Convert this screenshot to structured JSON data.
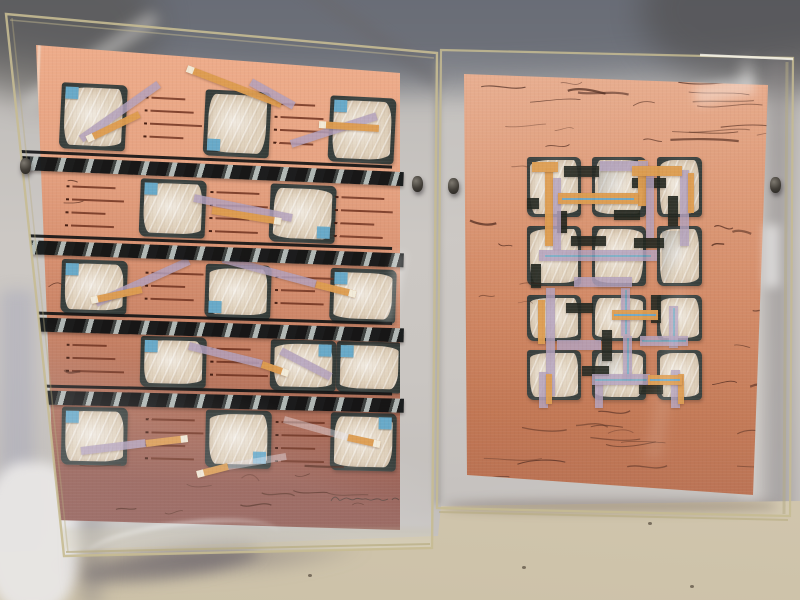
{
  "scene": {
    "type": "photograph",
    "subject": "Two abstract mixed-media collage artworks in clear acrylic box frames leaning against a gray fabric backdrop on a beige floor"
  },
  "palette": {
    "fabric": "#c6c2bf",
    "salmon_hi": "#efae8c",
    "cream": "#e0d2bd",
    "charcoal": "#3a403d",
    "blue_chip": "#68a9c8",
    "orange": "#dd9c4f",
    "lavender": "#b2a0bc",
    "pinstripe_blue": "#6fa7c4",
    "scribble": "#4a2418",
    "acrylic_edge": "#c6bb92",
    "floor": "#d5cab2"
  },
  "left_artwork": {
    "grid": {
      "cols": 5,
      "col_x": [
        26,
        105,
        170,
        235,
        295
      ],
      "cell_w": 66,
      "rows": [
        {
          "y": 37,
          "h": 66,
          "rot": 2.8,
          "cells": [
            {
              "c": 0,
              "chip": "tl"
            },
            {
              "c": 2,
              "chip": "bl"
            },
            {
              "c": 4,
              "chip": "tl"
            }
          ],
          "dash": [
            1,
            3
          ]
        },
        {
          "y": 130,
          "h": 58,
          "rot": 2.3,
          "cells": [
            {
              "c": 1,
              "chip": "tl"
            },
            {
              "c": 3,
              "chip": "br"
            }
          ],
          "dash": [
            0,
            2,
            4
          ]
        },
        {
          "y": 214,
          "h": 54,
          "rot": 1.9,
          "cells": [
            {
              "c": 0,
              "chip": "tl"
            },
            {
              "c": 2,
              "chip": "bl"
            },
            {
              "c": 4,
              "chip": "tl"
            }
          ],
          "dash": [
            1,
            3
          ]
        },
        {
          "y": 289,
          "h": 51,
          "rot": 1.5,
          "cells": [
            {
              "c": 1,
              "chip": "tl"
            },
            {
              "c": 3,
              "chip": "tr"
            },
            {
              "c": 4,
              "x": 301,
              "chip": "tl"
            }
          ],
          "dash": [
            0,
            2
          ]
        },
        {
          "y": 362,
          "h": 58,
          "rot": 1.2,
          "cells": [
            {
              "c": 0,
              "chip": "tl"
            },
            {
              "c": 2,
              "chip": "br"
            },
            {
              "c": 4,
              "chip": "tr"
            }
          ],
          "dash": [
            1,
            3
          ]
        }
      ]
    },
    "bars": {
      "x": -16,
      "w": 384,
      "items": [
        {
          "y": 106,
          "rot": 2.4
        },
        {
          "y": 190,
          "rot": 2.0
        },
        {
          "y": 267,
          "rot": 1.7
        },
        {
          "y": 340,
          "rot": 1.3
        }
      ]
    },
    "strips": [
      {
        "x1": 151,
        "y1": 24,
        "x2": 245,
        "y2": 60,
        "c": "orange",
        "tip": "start"
      },
      {
        "x1": 215,
        "y1": 38,
        "x2": 258,
        "y2": 62,
        "c": "lavender"
      },
      {
        "x1": 45,
        "y1": 95,
        "x2": 123,
        "y2": 40,
        "c": "lavender"
      },
      {
        "x1": 51,
        "y1": 95,
        "x2": 103,
        "y2": 70,
        "c": "orange",
        "tip": "start"
      },
      {
        "x1": 255,
        "y1": 100,
        "x2": 341,
        "y2": 72,
        "c": "lavender"
      },
      {
        "x1": 283,
        "y1": 80,
        "x2": 343,
        "y2": 84,
        "c": "orange",
        "tip": "start"
      },
      {
        "x1": 158,
        "y1": 154,
        "x2": 256,
        "y2": 174,
        "c": "lavender"
      },
      {
        "x1": 176,
        "y1": 166,
        "x2": 245,
        "y2": 177,
        "c": "orange",
        "tip": "end"
      },
      {
        "x1": 60,
        "y1": 259,
        "x2": 153,
        "y2": 217,
        "c": "lavender"
      },
      {
        "x1": 55,
        "y1": 256,
        "x2": 106,
        "y2": 245,
        "c": "orange",
        "tip": "start"
      },
      {
        "x1": 187,
        "y1": 215,
        "x2": 280,
        "y2": 240,
        "c": "lavender"
      },
      {
        "x1": 280,
        "y1": 240,
        "x2": 320,
        "y2": 250,
        "c": "orange",
        "tip": "end"
      },
      {
        "x1": 245,
        "y1": 307,
        "x2": 295,
        "y2": 333,
        "c": "lavender"
      },
      {
        "x1": 153,
        "y1": 302,
        "x2": 226,
        "y2": 320,
        "c": "lavender"
      },
      {
        "x1": 226,
        "y1": 320,
        "x2": 252,
        "y2": 329,
        "c": "orange",
        "tip": "end"
      },
      {
        "x1": 45,
        "y1": 407,
        "x2": 110,
        "y2": 399,
        "c": "lavender"
      },
      {
        "x1": 110,
        "y1": 399,
        "x2": 152,
        "y2": 394,
        "c": "orange",
        "tip": "end"
      },
      {
        "x1": 161,
        "y1": 430,
        "x2": 192,
        "y2": 422,
        "c": "orange",
        "tip": "start"
      },
      {
        "x1": 192,
        "y1": 422,
        "x2": 250,
        "y2": 412,
        "c": "sheer"
      },
      {
        "x1": 248,
        "y1": 375,
        "x2": 312,
        "y2": 393,
        "c": "sheer"
      },
      {
        "x1": 312,
        "y1": 393,
        "x2": 344,
        "y2": 400,
        "c": "orange",
        "tip": "end"
      }
    ],
    "scribble_zones": [
      {
        "x": 40,
        "y": 418,
        "w": 300,
        "h": 52,
        "n": 12,
        "min": 10,
        "max": 42
      },
      {
        "x": 6,
        "y": 120,
        "w": 26,
        "h": 280,
        "n": 5,
        "min": 8,
        "max": 20
      }
    ],
    "signature": {
      "note": "illegible pencil signature with date, lower right"
    }
  },
  "right_artwork": {
    "panel": {
      "cols_x": [
        65,
        130,
        195
      ],
      "cols_w": [
        54,
        54,
        45
      ],
      "rows_y": [
        83,
        152,
        221,
        276
      ],
      "rows_h": [
        60,
        60,
        46,
        50
      ],
      "streak_cells": [
        1,
        5,
        10
      ]
    },
    "v_strips": [
      {
        "x": 83,
        "y": 94,
        "w": 8,
        "h": 78,
        "c": "orange"
      },
      {
        "x": 91,
        "y": 104,
        "w": 8,
        "h": 72,
        "c": "lavender"
      },
      {
        "x": 84,
        "y": 214,
        "w": 9,
        "h": 108,
        "c": "lavender"
      },
      {
        "x": 76,
        "y": 226,
        "w": 7,
        "h": 44,
        "c": "orange"
      },
      {
        "x": 176,
        "y": 86,
        "w": 8,
        "h": 46,
        "c": "orange"
      },
      {
        "x": 184,
        "y": 92,
        "w": 8,
        "h": 72,
        "c": "lavender"
      },
      {
        "x": 218,
        "y": 96,
        "w": 9,
        "h": 76,
        "c": "lavender"
      },
      {
        "x": 226,
        "y": 99,
        "w": 6,
        "h": 40,
        "c": "orange"
      },
      {
        "x": 159,
        "y": 214,
        "w": 9,
        "h": 48,
        "c": "lavender",
        "inner": "blue"
      },
      {
        "x": 161,
        "y": 262,
        "w": 9,
        "h": 44,
        "c": "lavender",
        "inner": "blue"
      },
      {
        "x": 77,
        "y": 298,
        "w": 9,
        "h": 36,
        "c": "lavender"
      },
      {
        "x": 84,
        "y": 300,
        "w": 6,
        "h": 30,
        "c": "orange"
      },
      {
        "x": 207,
        "y": 232,
        "w": 9,
        "h": 42,
        "c": "lavender",
        "inner": "blue"
      },
      {
        "x": 209,
        "y": 296,
        "w": 9,
        "h": 38,
        "c": "lavender"
      },
      {
        "x": 216,
        "y": 300,
        "w": 6,
        "h": 30,
        "c": "orange"
      },
      {
        "x": 133,
        "y": 308,
        "w": 8,
        "h": 26,
        "c": "lavender"
      }
    ],
    "h_strips": [
      {
        "x": 138,
        "y": 87,
        "w": 48,
        "h": 10,
        "c": "lavender"
      },
      {
        "x": 96,
        "y": 119,
        "w": 80,
        "h": 11,
        "c": "orange",
        "inner": "blue"
      },
      {
        "x": 170,
        "y": 92,
        "w": 50,
        "h": 10,
        "c": "orange"
      },
      {
        "x": 77,
        "y": 176,
        "w": 118,
        "h": 11,
        "c": "lavender",
        "inner": "blue"
      },
      {
        "x": 112,
        "y": 203,
        "w": 58,
        "h": 10,
        "c": "lavender"
      },
      {
        "x": 150,
        "y": 236,
        "w": 46,
        "h": 10,
        "c": "orange",
        "inner": "blue"
      },
      {
        "x": 178,
        "y": 262,
        "w": 48,
        "h": 10,
        "c": "lavender",
        "inner": "blue"
      },
      {
        "x": 95,
        "y": 266,
        "w": 44,
        "h": 10,
        "c": "lavender"
      },
      {
        "x": 130,
        "y": 300,
        "w": 58,
        "h": 11,
        "c": "lavender",
        "inner": "blue"
      },
      {
        "x": 186,
        "y": 301,
        "w": 34,
        "h": 10,
        "c": "orange",
        "inner": "blue"
      },
      {
        "x": 70,
        "y": 88,
        "w": 26,
        "h": 10,
        "c": "orange"
      }
    ],
    "black_bars": [
      {
        "x": 102,
        "y": 92,
        "w": 35,
        "h": 11
      },
      {
        "x": 170,
        "y": 104,
        "w": 34,
        "h": 10
      },
      {
        "x": 206,
        "y": 122,
        "w": 10,
        "h": 30
      },
      {
        "x": 109,
        "y": 162,
        "w": 35,
        "h": 10
      },
      {
        "x": 172,
        "y": 164,
        "w": 30,
        "h": 10
      },
      {
        "x": 69,
        "y": 190,
        "w": 10,
        "h": 24
      },
      {
        "x": 104,
        "y": 229,
        "w": 27,
        "h": 10
      },
      {
        "x": 140,
        "y": 256,
        "w": 10,
        "h": 31
      },
      {
        "x": 189,
        "y": 221,
        "w": 10,
        "h": 28
      },
      {
        "x": 120,
        "y": 292,
        "w": 27,
        "h": 10
      },
      {
        "x": 65,
        "y": 124,
        "w": 12,
        "h": 11
      },
      {
        "x": 152,
        "y": 136,
        "w": 26,
        "h": 10
      },
      {
        "x": 177,
        "y": 310,
        "w": 24,
        "h": 10
      },
      {
        "x": 95,
        "y": 137,
        "w": 10,
        "h": 22
      }
    ],
    "scribble_zones": [
      {
        "x": 8,
        "y": 6,
        "w": 288,
        "h": 72,
        "n": 20,
        "min": 18,
        "max": 70
      },
      {
        "x": 4,
        "y": 85,
        "w": 55,
        "h": 240,
        "n": 6,
        "min": 10,
        "max": 30
      },
      {
        "x": 244,
        "y": 85,
        "w": 54,
        "h": 235,
        "n": 7,
        "min": 10,
        "max": 34
      },
      {
        "x": 10,
        "y": 332,
        "w": 278,
        "h": 78,
        "n": 14,
        "min": 16,
        "max": 60
      }
    ]
  },
  "hardware": {
    "clips": [
      {
        "x": 20,
        "y": 158
      },
      {
        "x": 412,
        "y": 176
      },
      {
        "x": 448,
        "y": 178
      },
      {
        "x": 770,
        "y": 177
      }
    ]
  },
  "floor": {
    "specks": [
      {
        "x": 690,
        "y": 585
      },
      {
        "x": 522,
        "y": 566
      },
      {
        "x": 308,
        "y": 574
      },
      {
        "x": 648,
        "y": 522
      }
    ]
  }
}
